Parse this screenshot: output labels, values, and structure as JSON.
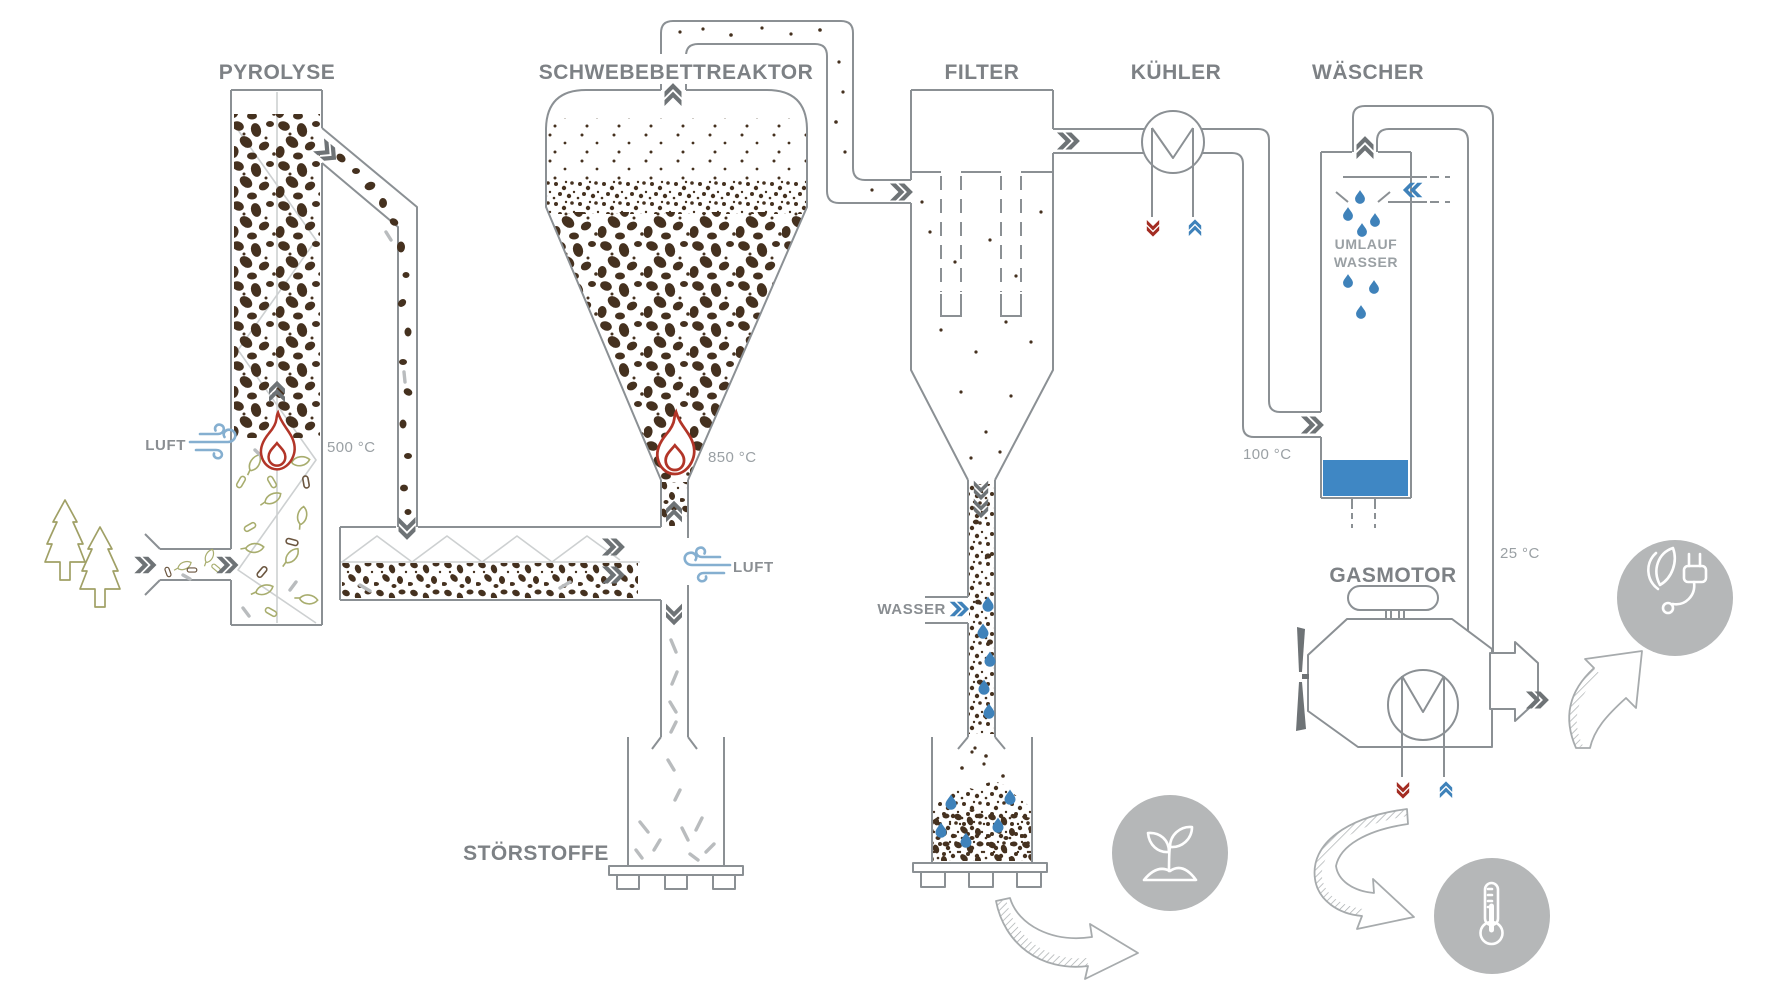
{
  "diagram": {
    "labels": {
      "pyrolyse": "PYROLYSE",
      "reaktor": "SCHWEBEBETTREAKTOR",
      "filter": "FILTER",
      "kuehler": "KÜHLER",
      "waescher": "WÄSCHER",
      "gasmotor": "GASMOTOR",
      "stoerstoffe": "STÖRSTOFFE",
      "luft_pyrolyse": "LUFT",
      "luft_reaktor": "LUFT",
      "wasser_filter": "WASSER",
      "umlauf_line1": "UMLAUF",
      "umlauf_line2": "WASSER"
    },
    "temperatures": {
      "pyrolyse": "500 °C",
      "reaktor": "850 °C",
      "waescher": "100 °C",
      "gasmotor": "25 °C"
    },
    "icons": [
      "wind-icon",
      "flame-icon",
      "water-drop-icon",
      "tree-icon",
      "leaf-icon",
      "heat-exchanger-icon",
      "fan-icon",
      "soil-plant-icon",
      "green-energy-plug-icon",
      "thermometer-icon",
      "flow-chevron-icon",
      "output-arrow-icon"
    ],
    "colors": {
      "line": "#8b9094",
      "label": "#7d8185",
      "temperature": "#9aa0a4",
      "chevron_dark": "#6e7376",
      "blue": "#3f82ba",
      "wind_blue": "#85afd0",
      "water_pool": "#3f87c4",
      "red": "#a32c22",
      "flame_red": "#b23528",
      "particle_brown": "#45311f",
      "circle_gray": "#b5b7b8",
      "tree_olive": "#a0a066",
      "leaf_green": "#a8ad6e"
    }
  }
}
